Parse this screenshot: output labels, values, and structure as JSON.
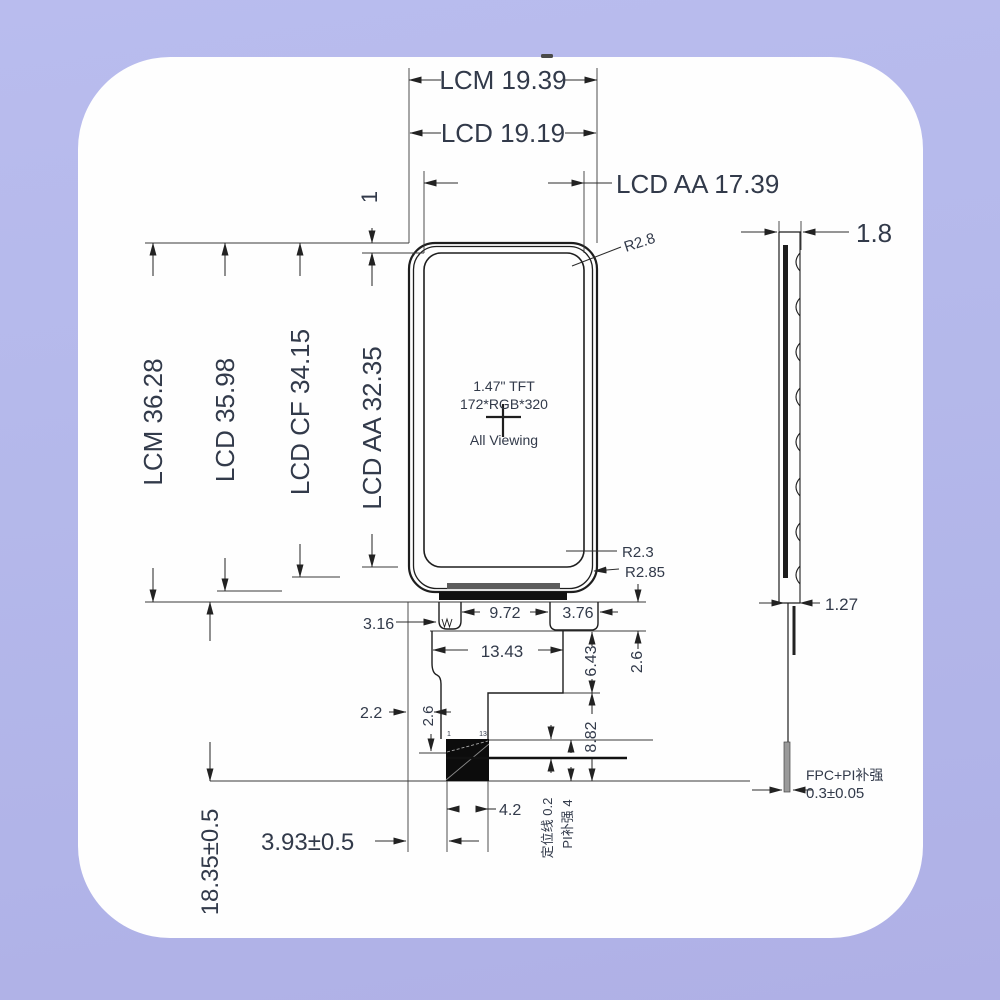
{
  "front": {
    "dims_top": {
      "lcm_w": "LCM 19.39",
      "lcd_w": "LCD 19.19",
      "aa_w": "LCD AA 17.39"
    },
    "dims_left": {
      "lcm_h": "LCM 36.28",
      "lcd_h": "LCD 35.98",
      "cf_h": "LCD CF 34.15",
      "aa_h": "LCD AA 32.35",
      "top_gap": "1"
    },
    "panel_text": {
      "size": "1.47\" TFT",
      "resolution": "172*RGB*320",
      "viewing": "All Viewing"
    },
    "corner_radii": {
      "top": "R2.8",
      "bottom_inner": "R2.3",
      "bottom_outer": "R2.85"
    },
    "fpc": {
      "tab_width": "3.16",
      "tab_gap": "9.72",
      "right_tab": "3.76",
      "neck_width": "13.43",
      "right_step": "6.43",
      "tab_height": "2.6",
      "edge_offset": "2.2",
      "left_step": "2.6",
      "tail_height": "8.82",
      "connector_width": "4.2",
      "pin_first": "1",
      "pin_last": "13",
      "locating_line": "定位线 0.2",
      "pi_stiffener": "PI补强 4",
      "tail_offset": "3.93±0.5",
      "tail_length": "18.35±0.5"
    }
  },
  "side": {
    "total_thickness": "1.8",
    "panel_thickness": "1.27",
    "fpc_note": "FPC+PI补强",
    "fpc_thickness": "0.3±0.05"
  }
}
